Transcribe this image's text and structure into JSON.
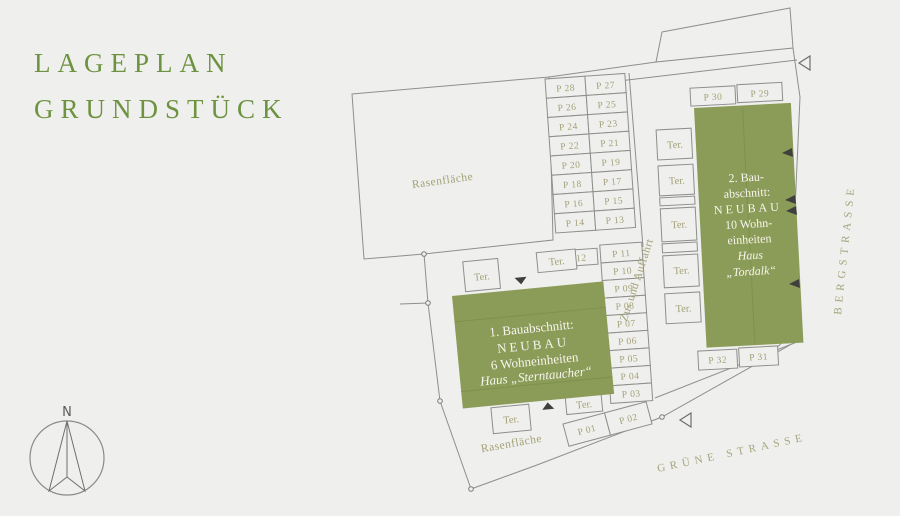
{
  "title": {
    "line1": "LAGEPLAN",
    "line2": "GRUNDSTÜCK"
  },
  "compass": {
    "north": "N"
  },
  "plan": {
    "streets": {
      "bergstrasse": "BERGSTRASSE",
      "gruene_strasse": "GRÜNE STRASSE"
    },
    "labels": {
      "lawn": "Rasenfläche",
      "driveway": "Zu- und Auffahrt",
      "terrace": "Ter."
    },
    "building1": {
      "line1": "1. Bauabschnitt:",
      "line2": "NEUBAU",
      "line3": "6 Wohneinheiten",
      "line4": "Haus „Sterntaucher“"
    },
    "building2": {
      "line1": "2. Bau-",
      "line2": "abschnitt:",
      "line3": "NEUBAU",
      "line4": "10 Wohn-",
      "line5": "einheiten",
      "line6": "Haus",
      "line7": "„Tordalk“"
    },
    "parking": {
      "p01": "P 01",
      "p02": "P 02",
      "p03": "P 03",
      "p04": "P 04",
      "p05": "P 05",
      "p06": "P 06",
      "p07": "P 07",
      "p08": "P 08",
      "p09": "P 09",
      "p10": "P 10",
      "p11": "P 11",
      "p12": "P 12",
      "p13": "P 13",
      "p14": "P 14",
      "p15": "P 15",
      "p16": "P 16",
      "p17": "P 17",
      "p18": "P 18",
      "p19": "P 19",
      "p20": "P 20",
      "p21": "P 21",
      "p22": "P 22",
      "p23": "P 23",
      "p24": "P 24",
      "p25": "P 25",
      "p26": "P 26",
      "p27": "P 27",
      "p28": "P 28",
      "p29": "P 29",
      "p30": "P 30",
      "p31": "P 31",
      "p32": "P 32"
    }
  },
  "colors": {
    "background": "#efefee",
    "building_green": "#8b9c58",
    "label_olive": "#a3a176",
    "title_green": "#6e9340",
    "line_gray": "#8e8e8c",
    "building_text": "#f7f5ee"
  }
}
